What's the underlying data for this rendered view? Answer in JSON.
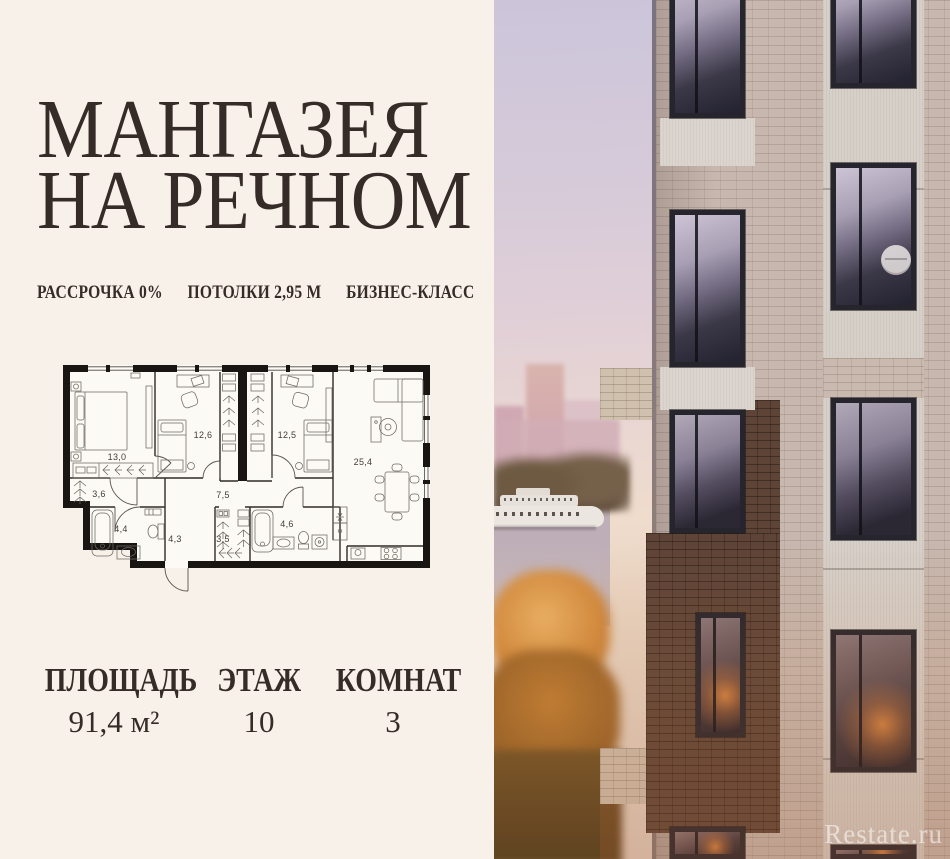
{
  "header": {
    "title_line1": "МАНГАЗЕЯ",
    "title_line2": "НА РЕЧНОМ"
  },
  "features": {
    "f1": "РАССРОЧКА 0%",
    "f2": "ПОТОЛКИ 2,95 М",
    "f3": "БИЗНЕС-КЛАСС"
  },
  "plan": {
    "r13": "13,0",
    "r126": "12,6",
    "r125": "12,5",
    "r254": "25,4",
    "r36": "3,6",
    "r75": "7,5",
    "r44": "4,4",
    "r43": "4,3",
    "r35": "3,5",
    "r46": "4,6"
  },
  "stats": {
    "s1_label": "ПЛОЩАДЬ",
    "s1_value": "91,4 м²",
    "s2_label": "ЭТАЖ",
    "s2_value": "10",
    "s3_label": "КОМНАТ",
    "s3_value": "3"
  },
  "watermark": "Restate.ru",
  "colors": {
    "background": "#f8f1e9",
    "text": "#352c27",
    "plan_walls": "#181512",
    "sky_top": "#ccc5da",
    "sky_bottom": "#efdccc",
    "brick": "#c7b7ae",
    "dark_brick": "#5e4437",
    "autumn": "#d28a3e"
  }
}
